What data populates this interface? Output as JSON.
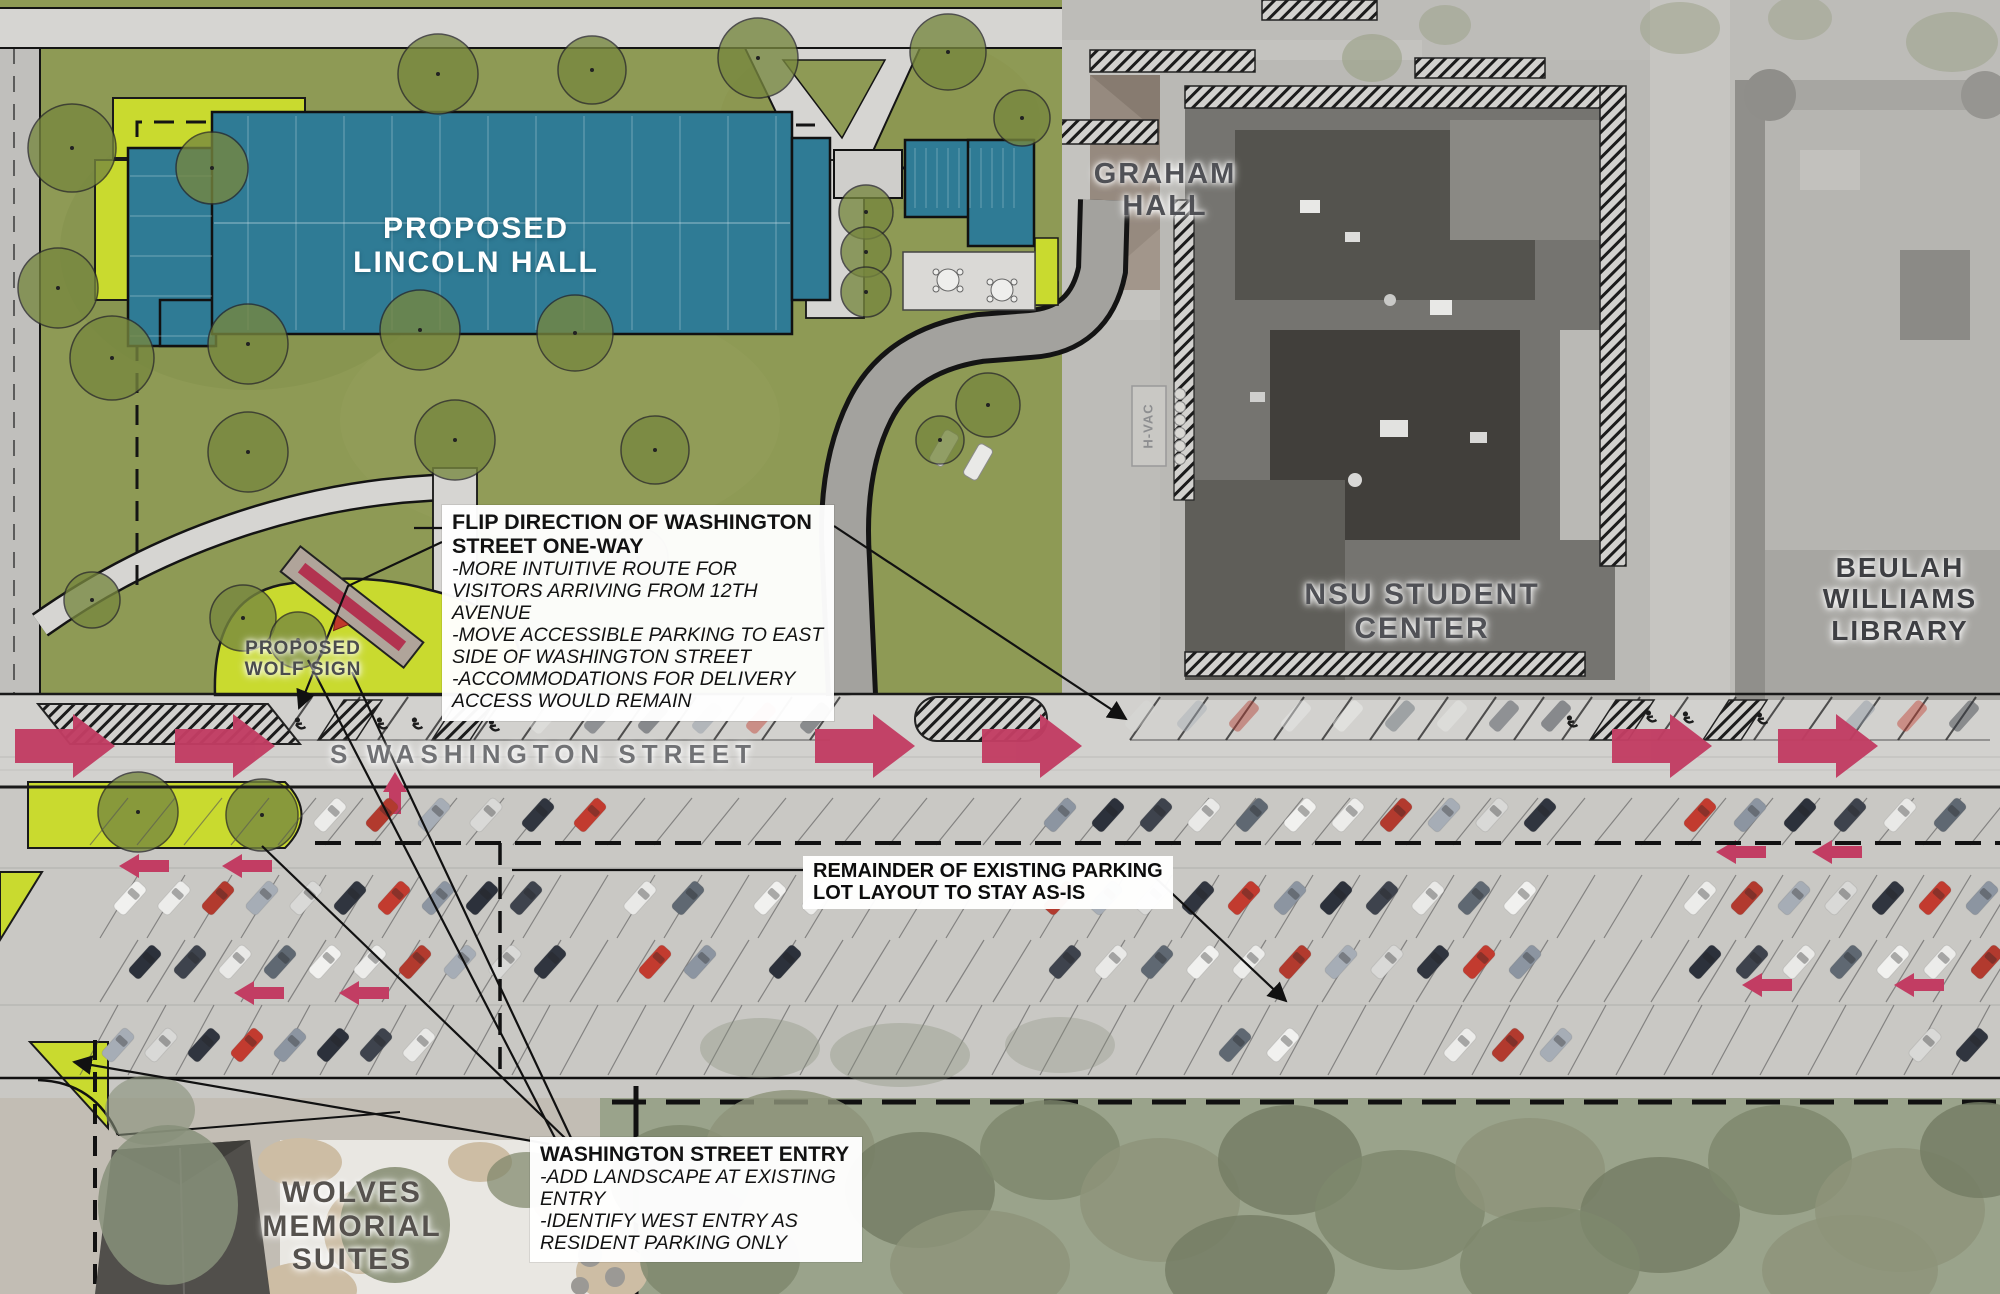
{
  "colors": {
    "teal_building": "#2f7b95",
    "teal_lines": "#d7e8ee",
    "lawn_green": "#8e9a55",
    "tree_green": "#77873f",
    "accent_chartreuse": "#c9da2f",
    "arrow_crimson": "#c23d63",
    "label_gray": "#505156",
    "path_gray": "#d6d5d2",
    "drive_gray": "#a3a29e",
    "line_black": "#141414",
    "callout_text": "#121212",
    "sign_band_red": "#b23350"
  },
  "buildings": {
    "lincoln": {
      "line1": "PROPOSED",
      "line2": "LINCOLN HALL"
    },
    "graham": {
      "line1": "GRAHAM",
      "line2": "HALL"
    },
    "nsu": {
      "line1": "NSU STUDENT",
      "line2": "CENTER"
    },
    "library": {
      "line1": "BEULAH",
      "line2": "WILLIAMS",
      "line3": "LIBRARY"
    },
    "wolves": {
      "line1": "WOLVES",
      "line2": "MEMORIAL",
      "line3": "SUITES"
    },
    "hvac": "H-VAC"
  },
  "street": {
    "name": "S WASHINGTON STREET"
  },
  "wolf_sign": {
    "line1": "PROPOSED",
    "line2": "WOLF SIGN"
  },
  "callouts": {
    "flip_direction": {
      "title": "FLIP DIRECTION OF WASHINGTON STREET ONE-WAY",
      "bullets": [
        "-MORE INTUITIVE ROUTE FOR VISITORS ARRIVING FROM 12TH AVENUE",
        "-MOVE ACCESSIBLE PARKING TO EAST SIDE OF WASHINGTON STREET",
        "-ACCOMMODATIONS FOR DELIVERY ACCESS WOULD REMAIN"
      ]
    },
    "street_entry": {
      "title": "WASHINGTON STREET ENTRY",
      "bullets": [
        "-ADD LANDSCAPE AT EXISTING ENTRY",
        "-IDENTIFY WEST ENTRY AS RESIDENT PARKING ONLY"
      ]
    },
    "parking_note": {
      "line1": "REMAINDER OF EXISTING PARKING",
      "line2": "LOT LAYOUT TO STAY AS-IS"
    }
  }
}
